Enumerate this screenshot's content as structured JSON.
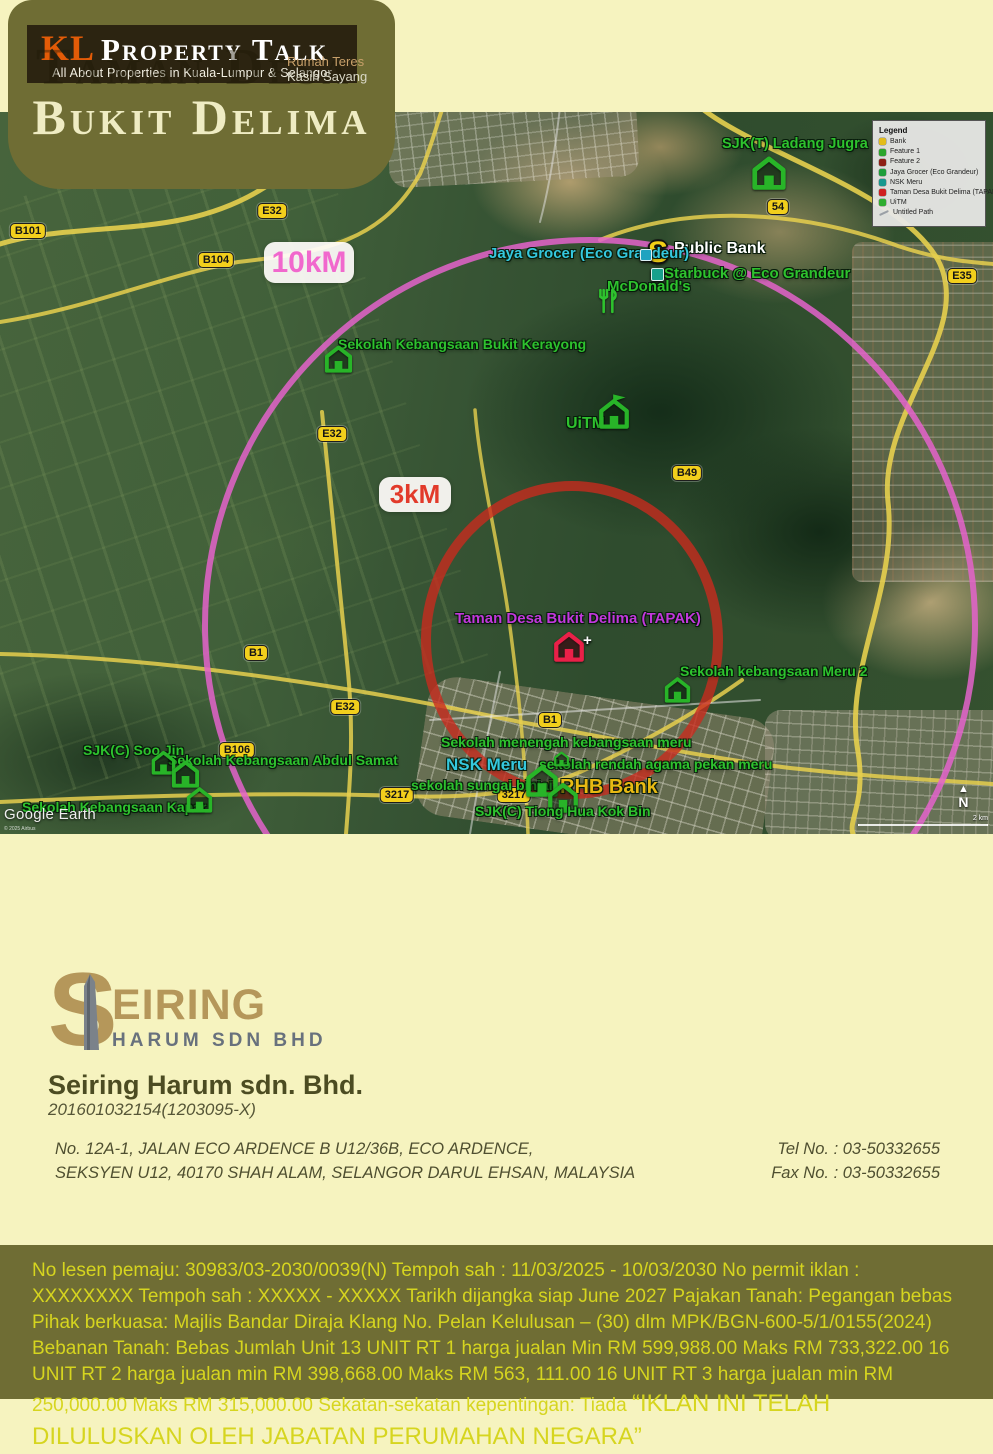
{
  "header": {
    "brand_kl": "KL",
    "brand_rest": "Property Talk",
    "tagline": "All About Properties in Kuala-Lumpur & Selangor",
    "ghost_title": "Taman Desa",
    "note1": "Rumah Teres",
    "note2": "Kasih Sayang",
    "project_title": "Bukit Delima"
  },
  "map": {
    "radius_labels": [
      {
        "text": "10kM",
        "x": 264,
        "y": 130,
        "w": 90,
        "h": 41,
        "fs": 30,
        "color": "#f168cd"
      },
      {
        "text": "3kM",
        "x": 379,
        "y": 365,
        "w": 72,
        "h": 35,
        "fs": 26,
        "color": "#e23a2a"
      }
    ],
    "circles": {
      "outer_color": "#e463cb",
      "inner_color": "#cb2a1e"
    },
    "label_colors": {
      "green": "#2ec22e",
      "cyan": "#35c8de",
      "magenta": "#c238dc",
      "white": "#ffffff",
      "gold": "#e8b913"
    },
    "pois": [
      {
        "label": "SJK(T) Ladang Jugra",
        "x": 722,
        "y": 25,
        "fs": 14.5,
        "c": "green",
        "icons": [
          {
            "t": "house",
            "x": 750,
            "y": 39,
            "s": 38
          }
        ]
      },
      {
        "label": "Public Bank",
        "x": 674,
        "y": 129,
        "fs": 16,
        "c": "white",
        "icons": [
          {
            "t": "dollar",
            "x": 648,
            "y": 126,
            "s": 30
          }
        ]
      },
      {
        "label": "Starbuck @ Eco Grandeur",
        "x": 664,
        "y": 154,
        "fs": 15,
        "c": "green",
        "icons": [
          {
            "t": "square",
            "x": 651,
            "y": 156,
            "s": 11,
            "col": "#18a08c"
          }
        ]
      },
      {
        "label": "McDonald's",
        "x": 607,
        "y": 167,
        "fs": 15,
        "c": "green",
        "icons": [
          {
            "t": "utensils",
            "x": 596,
            "y": 176,
            "s": 24
          }
        ]
      },
      {
        "label": "Jaya Grocer (Eco Grandeur)",
        "x": 489,
        "y": 134,
        "fs": 15,
        "c": "cyan",
        "icons": [
          {
            "t": "square",
            "x": 640,
            "y": 137,
            "s": 10,
            "col": "#1fa3c0"
          }
        ]
      },
      {
        "label": "Sekolah Kebangsaan Bukit Kerayong",
        "x": 338,
        "y": 225,
        "fs": 14,
        "c": "green",
        "icons": [
          {
            "t": "house",
            "x": 323,
            "y": 229,
            "s": 31
          }
        ]
      },
      {
        "label": "UiTM",
        "x": 566,
        "y": 304,
        "fs": 16,
        "c": "green",
        "icons": [
          {
            "t": "house-flag",
            "x": 597,
            "y": 282,
            "s": 34
          }
        ]
      },
      {
        "label": "Taman Desa Bukit Delima (TAPAK)",
        "x": 455,
        "y": 499,
        "fs": 15,
        "c": "magenta",
        "icons": [
          {
            "t": "house-red",
            "x": 552,
            "y": 515,
            "s": 34
          },
          {
            "t": "plus",
            "x": 583,
            "y": 521,
            "s": 15
          }
        ]
      },
      {
        "label": "Sekolah kebangsaan Meru 2",
        "x": 680,
        "y": 552,
        "fs": 14,
        "c": "green",
        "icons": [
          {
            "t": "house",
            "x": 663,
            "y": 561,
            "s": 29
          }
        ]
      },
      {
        "label": "Sekolah menengah kebangsaan meru",
        "x": 441,
        "y": 623,
        "fs": 14,
        "c": "green",
        "icons": []
      },
      {
        "label": "NSK Meru",
        "x": 446,
        "y": 644,
        "fs": 17,
        "c": "cyan",
        "icons": []
      },
      {
        "label": "sekolah rendah agama pekan meru",
        "x": 539,
        "y": 645,
        "fs": 14,
        "c": "green",
        "icons": [
          {
            "t": "house",
            "x": 553,
            "y": 637,
            "s": 17
          }
        ]
      },
      {
        "label": "sekolah sungai binjai",
        "x": 411,
        "y": 666,
        "fs": 14,
        "c": "green",
        "icons": []
      },
      {
        "label": "RHB Bank",
        "x": 560,
        "y": 665,
        "fs": 20,
        "c": "gold",
        "icons": [
          {
            "t": "house",
            "x": 524,
            "y": 648,
            "s": 36
          },
          {
            "t": "house",
            "x": 546,
            "y": 666,
            "s": 34
          }
        ]
      },
      {
        "label": "SJK(C) Tiong Hua Kok Bin",
        "x": 475,
        "y": 692,
        "fs": 14,
        "c": "green",
        "icons": []
      },
      {
        "label": "SJK(C) Soo Jin",
        "x": 83,
        "y": 631,
        "fs": 14,
        "c": "green",
        "icons": []
      },
      {
        "label": "Sekolah Kebangsaan Abdul Samat",
        "x": 168,
        "y": 641,
        "fs": 14,
        "c": "green",
        "icons": [
          {
            "t": "house",
            "x": 150,
            "y": 635,
            "s": 27
          },
          {
            "t": "house",
            "x": 170,
            "y": 644,
            "s": 31
          }
        ]
      },
      {
        "label": "Sekolah Kebangsaan Kapar",
        "x": 22,
        "y": 688,
        "fs": 14,
        "c": "green",
        "icons": [
          {
            "t": "house",
            "x": 185,
            "y": 671,
            "s": 29
          }
        ]
      }
    ],
    "road_badges": [
      {
        "label": "E32",
        "x": 272,
        "y": 99
      },
      {
        "label": "B101",
        "x": 28,
        "y": 119
      },
      {
        "label": "B104",
        "x": 216,
        "y": 148
      },
      {
        "label": "54",
        "x": 778,
        "y": 95
      },
      {
        "label": "E35",
        "x": 962,
        "y": 164
      },
      {
        "label": "E32",
        "x": 332,
        "y": 322
      },
      {
        "label": "B49",
        "x": 687,
        "y": 361
      },
      {
        "label": "B1",
        "x": 256,
        "y": 541
      },
      {
        "label": "E32",
        "x": 345,
        "y": 595
      },
      {
        "label": "B1",
        "x": 550,
        "y": 608
      },
      {
        "label": "B106",
        "x": 237,
        "y": 638
      },
      {
        "label": "3217",
        "x": 397,
        "y": 683
      },
      {
        "label": "3217",
        "x": 514,
        "y": 683
      }
    ],
    "legend": {
      "title": "Legend",
      "items": [
        {
          "label": "Bank",
          "color": "#e3bc1a",
          "shape": "swatch"
        },
        {
          "label": "Feature 1",
          "color": "#2ba52b",
          "shape": "swatch"
        },
        {
          "label": "Feature 2",
          "color": "#8e1f14",
          "shape": "swatch"
        },
        {
          "label": "Jaya Grocer (Eco Grandeur)",
          "color": "#1e9e3a",
          "shape": "swatch"
        },
        {
          "label": "NSK Meru",
          "color": "#16988f",
          "shape": "swatch"
        },
        {
          "label": "Taman Desa Bukit Delima (TAPAK)",
          "color": "#cf1f1f",
          "shape": "swatch"
        },
        {
          "label": "UiTM",
          "color": "#2fae2f",
          "shape": "swatch"
        },
        {
          "label": "Untitled Path",
          "color": "#9aa0a6",
          "shape": "line"
        }
      ]
    },
    "watermark": "Google Earth",
    "attribution": "© 2025 Airbus",
    "scale_label": "2 km",
    "north_label": "N",
    "north_arrow": "▲"
  },
  "company": {
    "logo_initial": "S",
    "logo_name": "EIRING",
    "logo_sub": "HARUM SDN BHD",
    "name": "Seiring Harum sdn. Bhd.",
    "reg_no": "201601032154(1203095-X)",
    "address_line1": "No. 12A-1, JALAN ECO ARDENCE B U12/36B, ECO ARDENCE,",
    "address_line2": "SEKSYEN U12, 40170 SHAH ALAM, SELANGOR DARUL EHSAN, MALAYSIA",
    "tel": "Tel No. : 03-50332655",
    "fax": "Fax No. : 03-50332655"
  },
  "footer": {
    "legal_text": "No lesen pemaju: 30983/03-2030/0039(N) Tempoh sah : 11/03/2025 - 10/03/2030  No permit iklan : XXXXXXXX  Tempoh sah : XXXXX - XXXXX  Tarikh dijangka siap June 2027 Pajakan Tanah: Pegangan bebas  Pihak berkuasa: Majlis Bandar Diraja Klang  No. Pelan Kelulusan – (30) dlm MPK/BGN-600-5/1/0155(2024) Bebanan Tanah: Bebas Jumlah Unit 13 UNIT RT 1 harga jualan Min RM 599,988.00 Maks RM 733,322.00 16 UNIT RT 2 harga jualan min RM 398,668.00 Maks  RM 563, 111.00 16 UNIT RT 3 harga jualan min RM 250,000.00 Maks RM 315,000.00 Sekatan-sekatan kepentingan: Tiada",
    "approval_text": "“IKLAN INI TELAH DILULUSKAN OLEH JABATAN PERUMAHAN NEGARA”"
  },
  "colors": {
    "page_background": "#f6f3bf",
    "olive_panel": "#6f6d34",
    "footer_text": "#d6d51f",
    "brand_orange": "#e35b07",
    "logo_gold": "#b5975a",
    "outer_circle_pink": "#e463cb",
    "inner_circle_red": "#cb2a1e",
    "road_badge_yellow": "#f2cf1c"
  }
}
